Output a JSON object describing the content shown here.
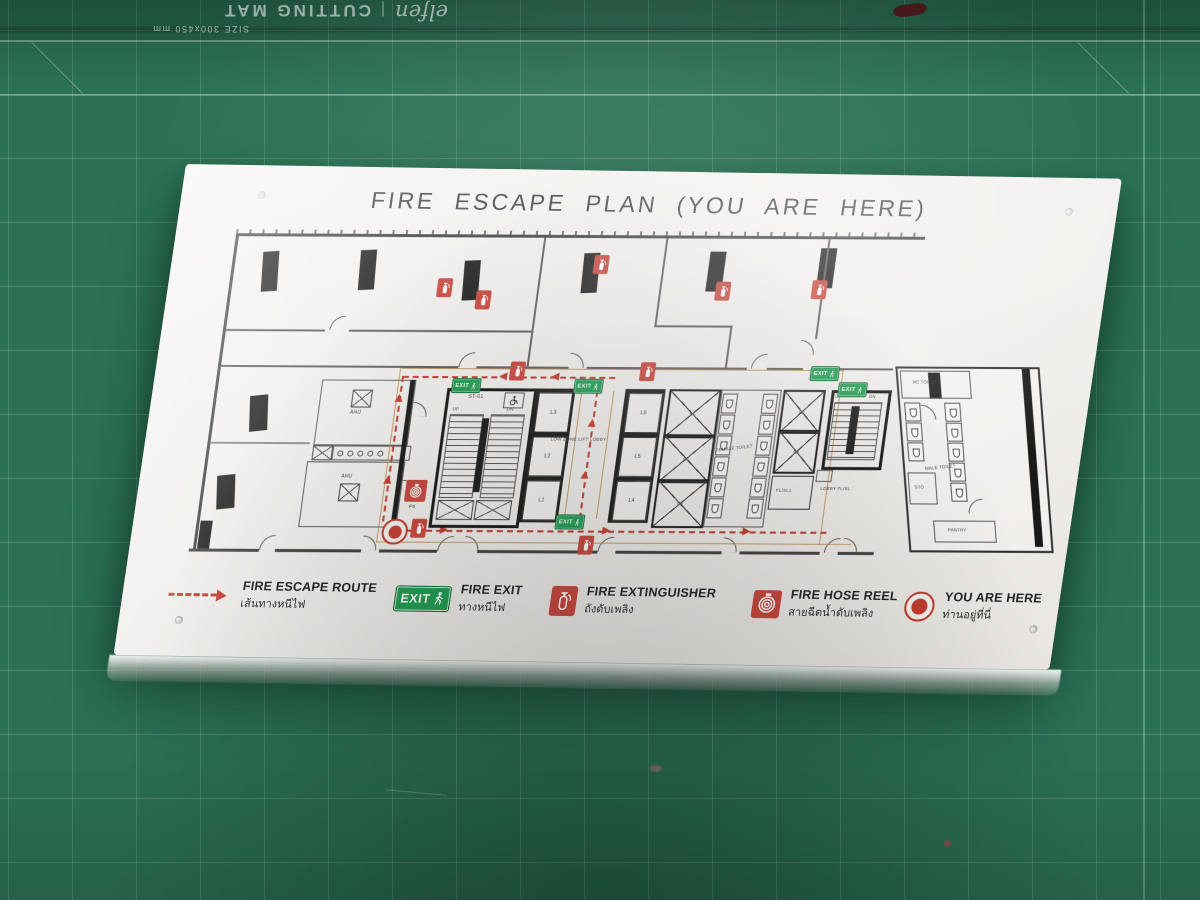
{
  "mat": {
    "brand": "elfen",
    "label": "CUTTING MAT",
    "size": "SIZE 300x450 mm"
  },
  "sign": {
    "title": "FIRE ESCAPE PLAN (YOU ARE HERE)"
  },
  "plan": {
    "exit_label": "EXIT",
    "stair1_label": "ST-01",
    "up": "UP",
    "dn": "DN",
    "ahu": "AHU",
    "fs": "FS",
    "lift_lobby": "LOW ZONE LIFT LOBBY",
    "lifts_low": [
      "L1",
      "L2",
      "L3",
      "L4",
      "L5",
      "L6"
    ],
    "lifts_high": [
      "H6",
      "H5",
      "H4",
      "H2",
      "H1"
    ],
    "rooms": {
      "female_toilet": "FEMALE TOILET",
      "male_toilet": "MALE TOILET",
      "hc_toilet": "HC TOILET",
      "storage": "STO",
      "pantry": "PANTRY",
      "fire_lift": "FL/SL1",
      "fire_lift_lobby": "LOBBY FL/SL"
    }
  },
  "legend": {
    "items": [
      {
        "icon": "route-arrow",
        "label": "FIRE ESCAPE ROUTE",
        "thai": "เส้นทางหนีไฟ"
      },
      {
        "icon": "exit-sign",
        "label": "FIRE EXIT",
        "thai": "ทางหนีไฟ"
      },
      {
        "icon": "fire-extinguisher",
        "label": "FIRE EXTINGUISHER",
        "thai": "ถังดับเพลิง"
      },
      {
        "icon": "hose-reel",
        "label": "FIRE HOSE REEL",
        "thai": "สายฉีดน้ำดับเพลิง"
      },
      {
        "icon": "you-are-here",
        "label": "YOU ARE HERE",
        "thai": "ท่านอยู่ที่นี่"
      }
    ]
  },
  "colors": {
    "mat_green": "#2b7254",
    "panel_white": "#f4f2ef",
    "route_red": "#c23b2e",
    "exit_green": "#1f9d50",
    "safety_red": "#c8443a",
    "corridor_tan": "#bb8a48"
  }
}
